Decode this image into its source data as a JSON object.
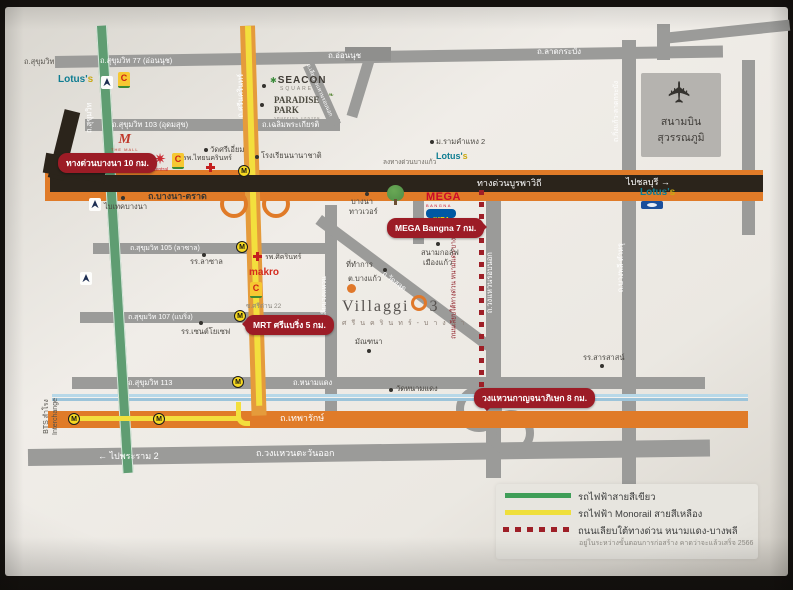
{
  "colors": {
    "road_gray": "#9b9b99",
    "expressway_dark": "#2b241b",
    "highway_orange": "#e07b28",
    "monorail_yellow": "#f3df3d",
    "bts_green": "#5f9d72",
    "canal_blue": "#a9cde2",
    "badge_red": "#9c1c26",
    "construction_red": "#9e1f27",
    "mega_red": "#cc0a2a",
    "ikea_blue": "#0058a3",
    "lotus_teal": "#0f7d92"
  },
  "icons": {
    "airplane": "✈",
    "starburst": "✷",
    "seacon_mark": "✱",
    "leaf": "❧"
  },
  "station_letter": "M",
  "roads": {
    "sukhumvit_corner": "ถ.สุขุมวิท",
    "sukhumvit77": "ถ.สุขุมวิท 77 (อ่อนนุช)",
    "onnut": "ถ.อ่อนนุช",
    "ladkrabang": "ถ.ลาดกระบัง",
    "kingkaew_ladkrabang": "ถ.กิ่งแก้ว-ลาดกระบัง",
    "sukhumvit103": "ถ.สุขุมวิท 103 (อุดมสุข)",
    "chalermprakiat": "ถ.เฉลิมพระเกียรติ",
    "liab_wongwaen_robnok": "ถ.เลียบวงแหวนรอบนอก",
    "sukhumvit_bts": "ถ.สุขุมวิท",
    "srinakarin": "ถ.ศรีนครินทร์",
    "bangna_trad": "ถ.บางนา-ตราด",
    "burapha_expressway": "ทางด่วนบูรพาวิถี",
    "to_chonburi": "ไปชลบุรี →",
    "exit_bangkaeo": "ลงทางด่วนบางแก้ว",
    "sukhumvit105": "ถ.สุขุมวิท 105 (ลาซาล)",
    "sridan22": "ซ.ศรีด่าน 22",
    "sukhumvit107": "ถ.สุขุมวิท 107 (แบริ่ง)",
    "sukhumvit113": "ถ.สุขุมวิท 113",
    "namdaeng": "ถ.หนามแดง",
    "wat_salud": "ถ.วัดสลุด",
    "liab_wongwaen": "ถ.เลียบวงแหวน",
    "wongwaen_robnok": "ถ.วงแหวนรอบนอก",
    "bangplee_tamru": "ถ.บางพลี-ตำหรุ",
    "under_expressway": "ถนนเลียบใต้ทางด่วน หนามแดง-บางพลี",
    "thepharak": "ถ.เทพารักษ์",
    "to_rama2": "← ไปพระราม 2",
    "wongwaen_east": "ถ.วงแหวนตะวันออก",
    "bts_samrong": "BTS สำโรง",
    "interchange": "Interchange"
  },
  "badges": {
    "expressway_bangna": "ทางด่วนบางนา 10 กม.",
    "mega_bangna": "MEGA Bangna 7 กม.",
    "mrt_sribearing": "MRT ศรีแบริ่ง 5 กม.",
    "wongwaen_kanchana": "วงแหวนกาญจนาภิเษก 8 กม."
  },
  "landmarks": {
    "lotus_a": "Lotus'",
    "lotus_b": "s",
    "the_mall_m": "M",
    "the_mall": "THE MALL",
    "central": "Central",
    "bigc": "C",
    "seacon": "SEACON",
    "seacon_sub": "SQUARE",
    "paradise": "PARADISE PARK",
    "paradise_sub": "SHOPPING CENTER",
    "intl_school": "โรงเรียนนานาชาติ",
    "wat_sri_iam": "วัดศรีเอี่ยม",
    "thainakarin_hospital": "รพ.ไทยนครินทร์",
    "bitec": "ไบเทคบางนา",
    "ramkhamhaeng2": "ม.รามคำแหง 2",
    "bangna_tower_1": "บางนา",
    "bangna_tower_2": "ทาวเวอร์",
    "mega": "MEGA",
    "mega_sub": "BANGNA",
    "ikea": "IKEA",
    "golf_1": "สนามกอล์ฟ",
    "golf_2": "เมืองแก้ว",
    "sikarin_hospital": "รพ.ศิครินทร์",
    "lasalle_school": "รร.ลาซาล",
    "stjoseph_school": "รร.เซนต์โยเซฟ",
    "makro": "makro",
    "district_office_1": "ที่ทำการ",
    "district_office_2": "ต.บางแก้ว",
    "manthana": "มัณฑนา",
    "wat_namdaeng": "วัดหนามแดง",
    "sarasas_school": "รร.สารสาสน์"
  },
  "villaggio": {
    "name": "Villaggi",
    "number": "3",
    "subtitle": "ศรีนครินทร์-บางนา"
  },
  "airport": {
    "line1": "สนามบิน",
    "line2": "สุวรรณภูมิ"
  },
  "legend": {
    "green": "รถไฟฟ้าสายสีเขียว",
    "yellow": "รถไฟฟ้า Monorail สายสีเหลือง",
    "red": "ถนนเลียบใต้ทางด่วน หนามแดง-บางพลี",
    "note": "อยู่ในระหว่างขั้นตอนการก่อสร้าง คาดว่าจะแล้วเสร็จ 2566"
  }
}
